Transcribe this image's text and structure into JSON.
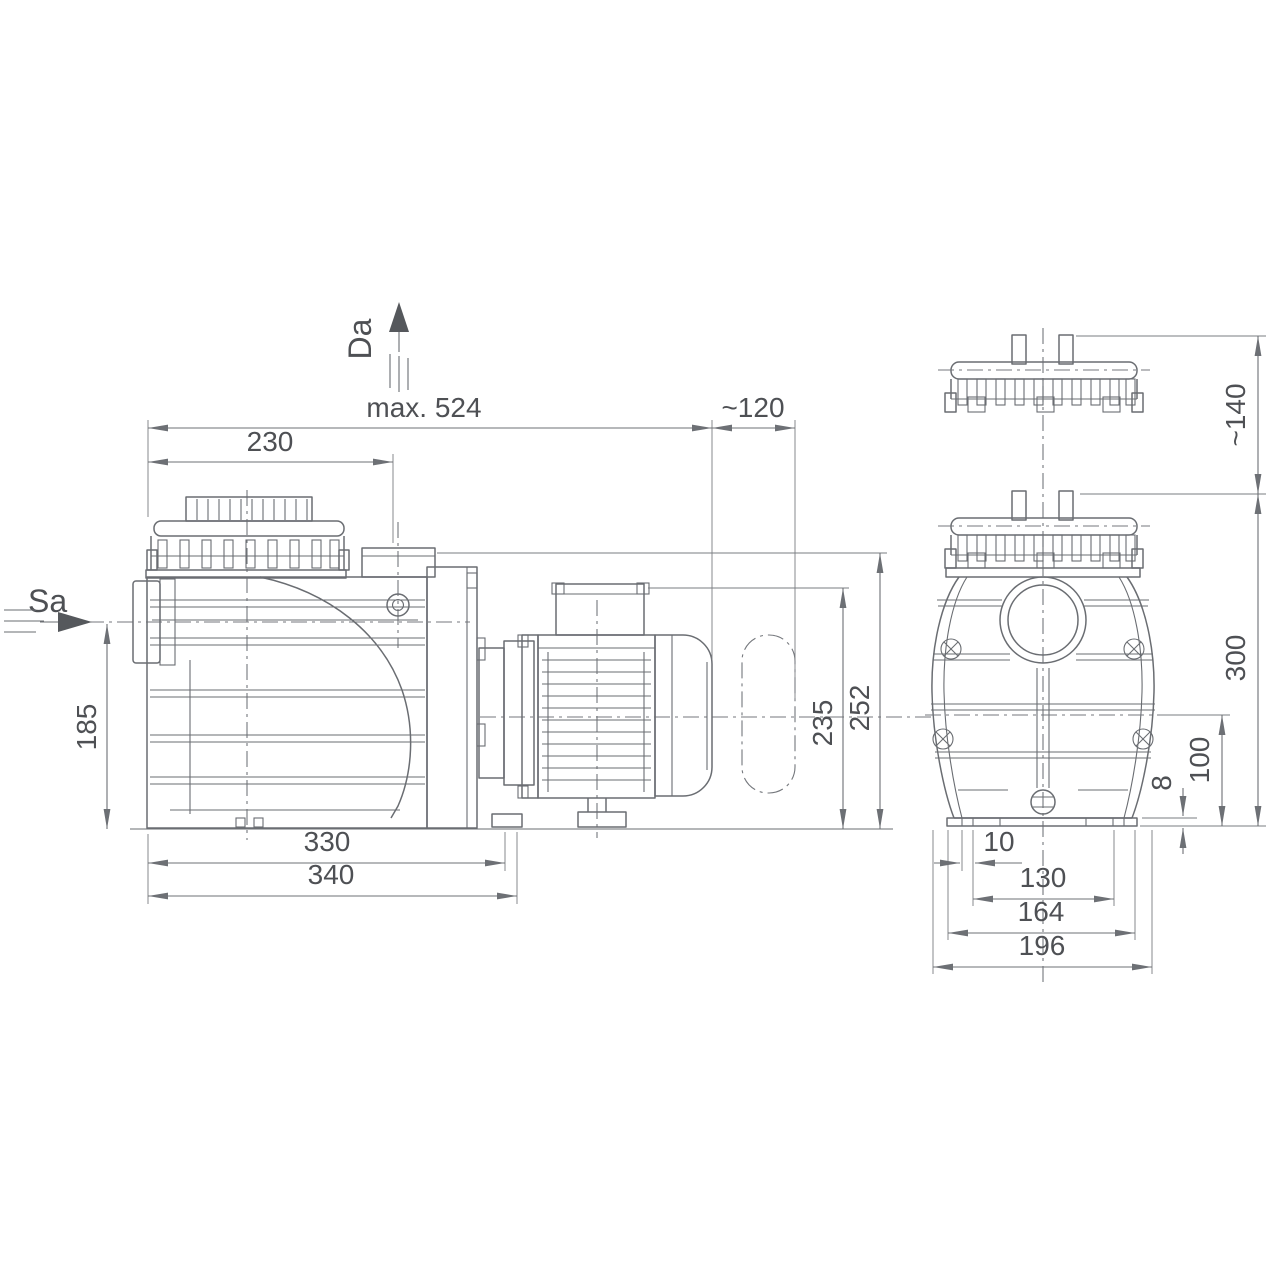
{
  "drawing": {
    "type": "pump-dimension-drawing",
    "colors": {
      "background": "#ffffff",
      "line": "#6a6d72",
      "text": "#4e5054"
    },
    "side_view": {
      "labels": {
        "suction_port": "Sa",
        "discharge_port": "Da"
      },
      "dims": {
        "total_length": "max. 524",
        "dismantle_clearance": "~120",
        "lid_offset": "230",
        "suction_height": "185",
        "housing_height": "235",
        "total_height": "252",
        "foot_length": "330",
        "base_length": "340"
      }
    },
    "front_view": {
      "dims": {
        "lid_clearance": "~140",
        "total_height": "300",
        "mount_height": "100",
        "base_thickness": "8",
        "slot_width": "10",
        "slot_spacing": "130",
        "base_width": "164",
        "overall_width": "196"
      }
    }
  }
}
